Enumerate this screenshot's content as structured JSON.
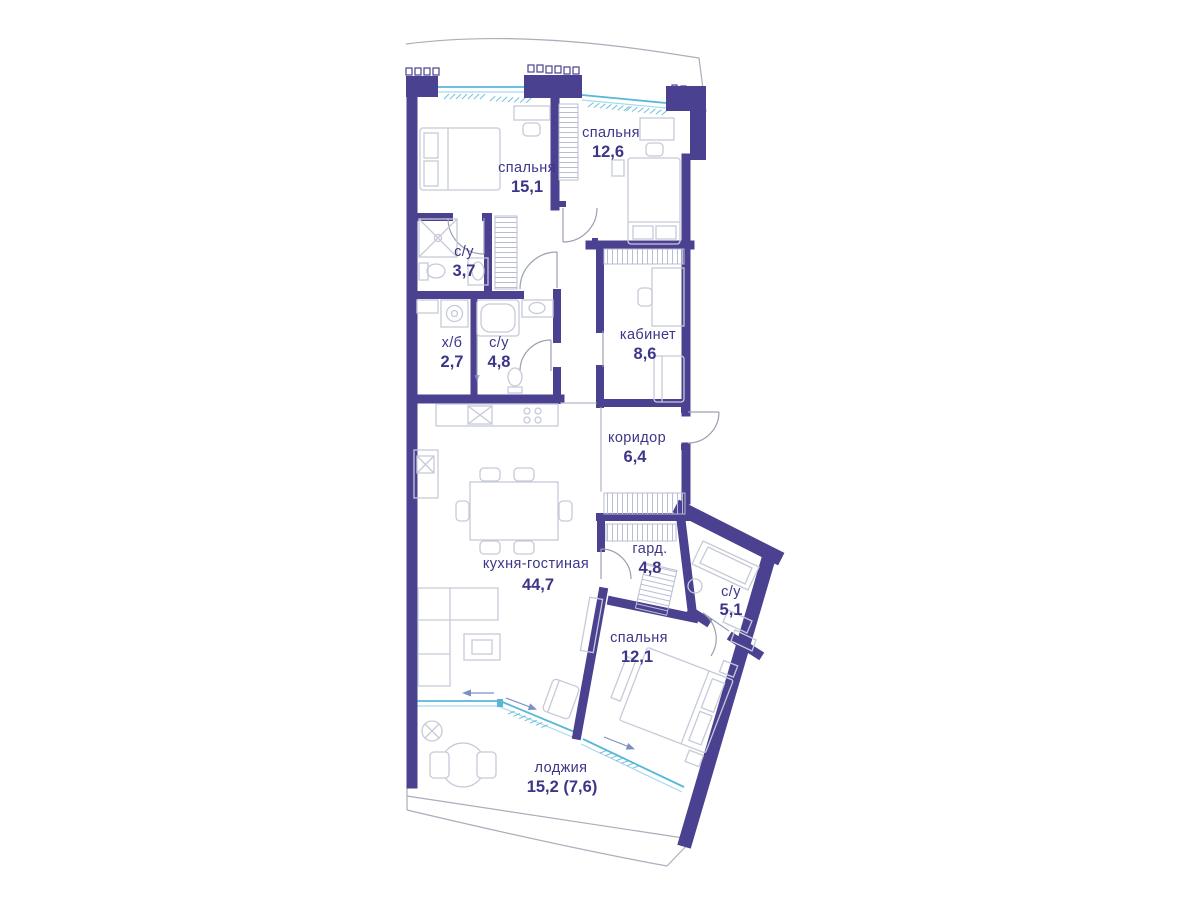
{
  "plan": {
    "type": "apartment-floor-plan",
    "language": "ru",
    "rooms": [
      {
        "id": "bedroom-1",
        "name": "спальня",
        "area": "15,1"
      },
      {
        "id": "bedroom-2",
        "name": "спальня",
        "area": "12,6"
      },
      {
        "id": "bathroom-1",
        "name": "с/у",
        "area": "3,7"
      },
      {
        "id": "utility",
        "name": "х/б",
        "area": "2,7"
      },
      {
        "id": "bathroom-2",
        "name": "с/у",
        "area": "4,8"
      },
      {
        "id": "office",
        "name": "кабинет",
        "area": "8,6"
      },
      {
        "id": "corridor",
        "name": "коридор",
        "area": "6,4"
      },
      {
        "id": "kitchen-living",
        "name": "кухня-гостиная",
        "area": "44,7"
      },
      {
        "id": "wardrobe",
        "name": "гард.",
        "area": "4,8"
      },
      {
        "id": "bathroom-3",
        "name": "с/у",
        "area": "5,1"
      },
      {
        "id": "bedroom-3",
        "name": "спальня",
        "area": "12,1"
      },
      {
        "id": "loggia",
        "name": "лоджия",
        "area": "15,2 (7,6)"
      }
    ],
    "colors": {
      "wall": "#4a4190",
      "window": "#58b7d8",
      "furniture": "#c6cad8",
      "label": "#3c3688",
      "contour": "#a9aeba"
    }
  }
}
